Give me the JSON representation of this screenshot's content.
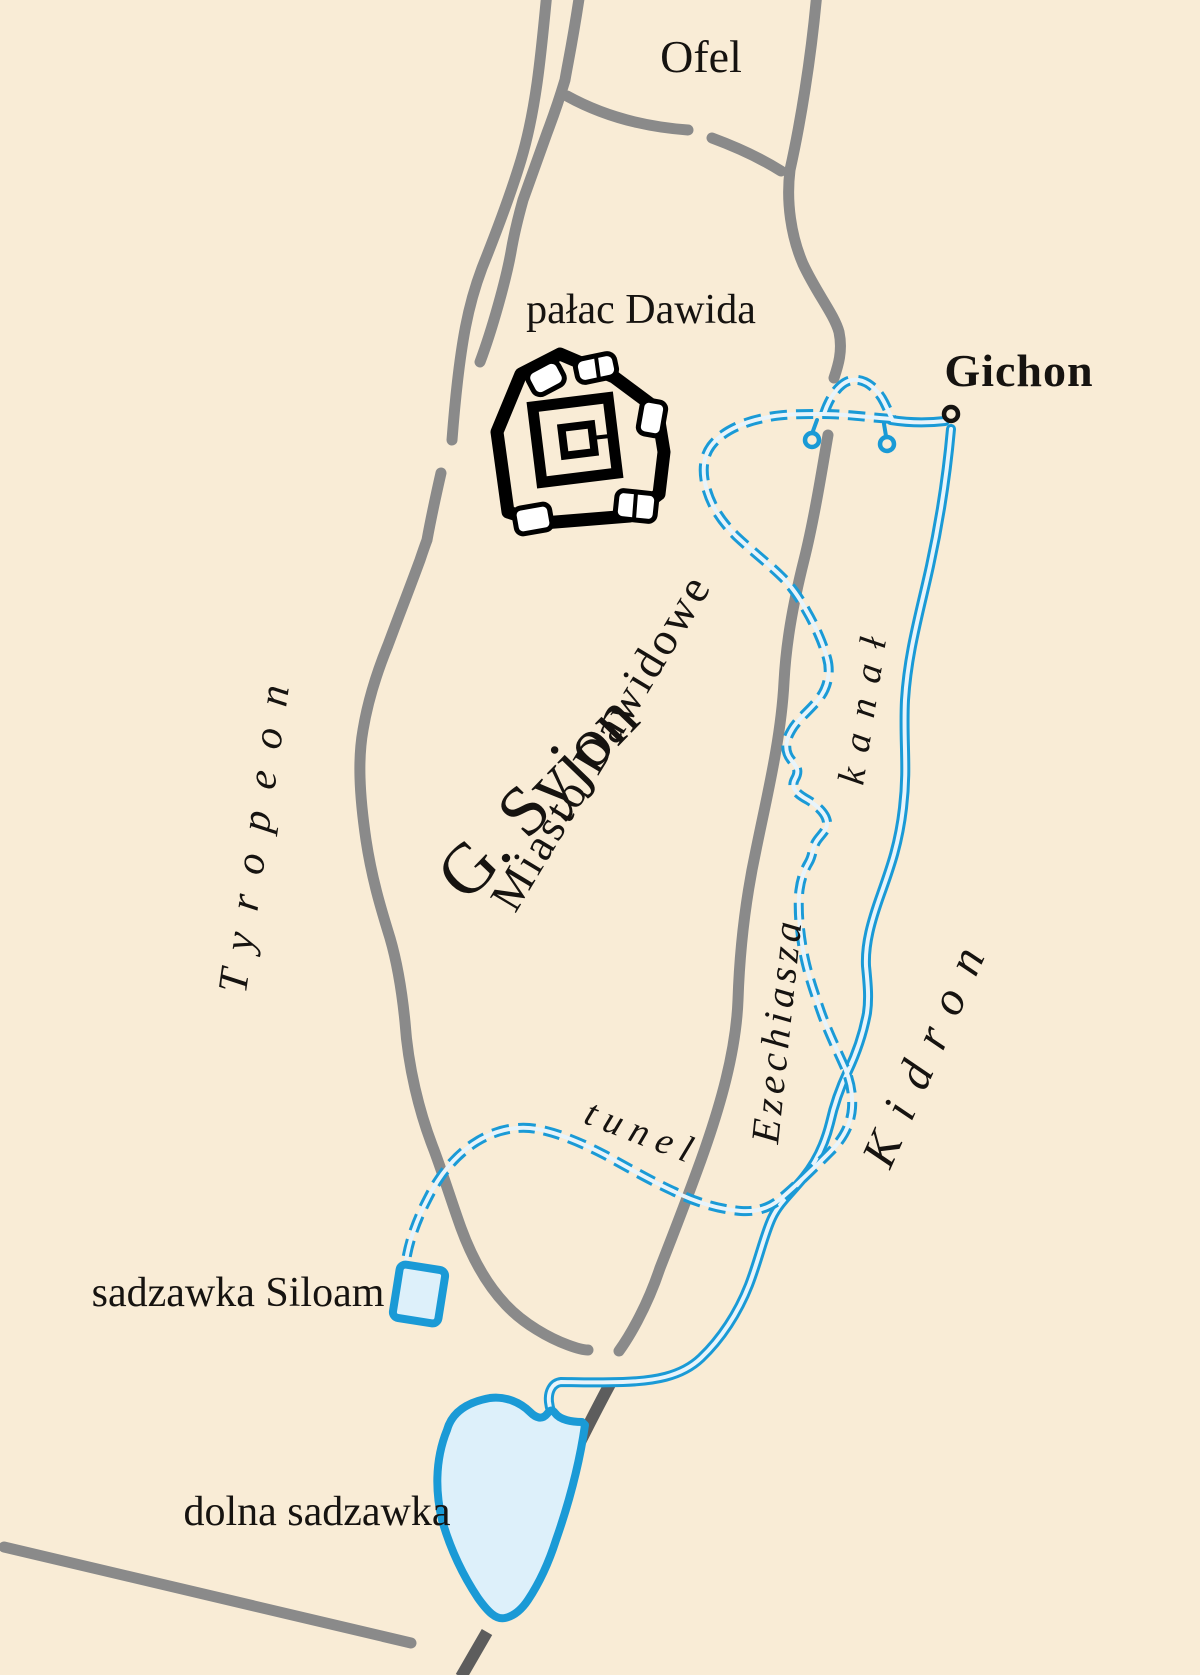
{
  "map": {
    "title": "Plan of the City of David (Jerusalem) with Hezekiah's water systems",
    "colors": {
      "background": "#f9ecd6",
      "wall": "#8a8a8a",
      "wall_dark": "#5d5d5d",
      "water": "#1a9ad6",
      "water_core": "#e8f4fb",
      "pool_fill": "#ddf0fa",
      "ink": "#161310"
    },
    "labels": {
      "ofel": "Ofel",
      "palac_dawida": "pałac Dawida",
      "gichon": "Gichon",
      "g_syjon": "G. Syjon",
      "miasto_dawidowe": "Miasto Dawidowe",
      "tyropeon": "Tyropeon",
      "kanal": "kanał",
      "tunel": "tunel",
      "ezechiasza": "Ezechiasza",
      "kidron": "Kidron",
      "sadzawka_siloam": "sadzawka Siloam",
      "dolna_sadzawka": "dolna sadzawka"
    },
    "features": {
      "spring": "Gichon spring (small circle)",
      "palace": "fortress plan icon (pałac Dawida)",
      "tunnel": "dashed blue line – Hezekiah's tunnel",
      "canal": "solid double blue line – canal",
      "siloam_pool": "small blue square pool",
      "lower_pool": "large light-blue pool",
      "city_walls": "grey wall lines",
      "dark_wall": "dark grey wall beside lower pool"
    }
  }
}
